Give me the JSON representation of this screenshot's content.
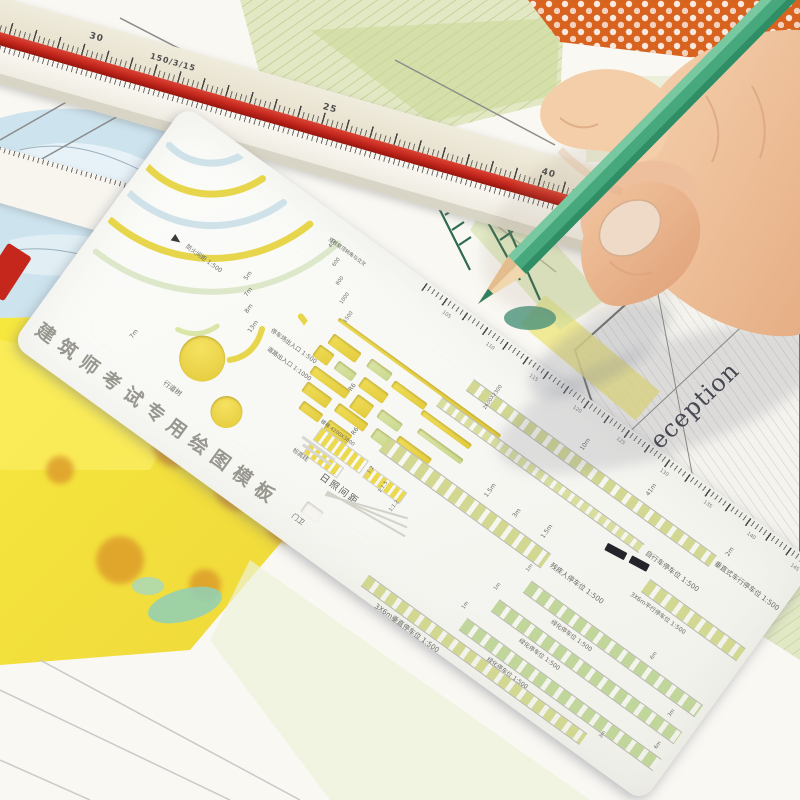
{
  "ruler": {
    "num_30": "30",
    "scale_label": "150/3/15",
    "num_25": "25",
    "num_40": "40",
    "num_75": "75"
  },
  "drawing": {
    "pool_label": "Pool",
    "reception_label": "Reception"
  },
  "template": {
    "title": "建筑师考试专用绘图模板",
    "section_roof": "双坡屋顶转角与交叉",
    "fire_gap": "防火间距 1:500",
    "arc_dims": {
      "a": "5m",
      "b": "7m",
      "c": "8m",
      "d": "13m"
    },
    "radius_dims": {
      "r1": "400",
      "r2": "600",
      "r3": "800",
      "r4": "1000",
      "r5": "1500",
      "r6": "R6"
    },
    "parking_gate": "停车场出入口 1:500",
    "road_gate": "道路出入口 1:1000",
    "street_tree": "行道树",
    "elevation_line": "标高线",
    "gate_guard": "门卫",
    "stairs": "楼梯 4200X3600",
    "sunlight": "日照间距",
    "sunlight_ratios": {
      "r1": "1:2",
      "r2": "1:1.5",
      "r3": "1:1.2"
    },
    "rows": {
      "vert_drive": "垂直式车行停车位 1:500",
      "bike": "自行车停车位 1:500",
      "disabled": "残疾人停车位 1:500",
      "parallel": "3X6m平行停车位 1:500",
      "green_a": "绿化停车位 1:500",
      "green_b": "绿化停车位 1:500",
      "green_c": "绿化停车位 1:500",
      "vertical": "3X6m垂直停车位 1:500"
    },
    "dims": {
      "d10m": "10m",
      "d41m": "41m",
      "d2m": "2m",
      "d15m": "1.5m",
      "d3m": "3m",
      "d1m": "1m",
      "d6m": "6m",
      "d7m": "7m",
      "d2600": "2600X2300"
    },
    "edge_scale": {
      "t1": "105",
      "t2": "110",
      "t3": "115",
      "t4": "120",
      "t5": "125",
      "t6": "130",
      "t7": "135",
      "t8": "140",
      "t9": "145"
    }
  },
  "colors": {
    "pencil_green": "#47a87d",
    "ruler_red": "#c5271d",
    "wash_yellow": "#f2e14b",
    "wash_orange": "#d8631f",
    "pool_blue": "#bddded",
    "hatch_green": "#cdd89f",
    "skin": "#efc3a0",
    "template_white": "#f7f7f3"
  }
}
